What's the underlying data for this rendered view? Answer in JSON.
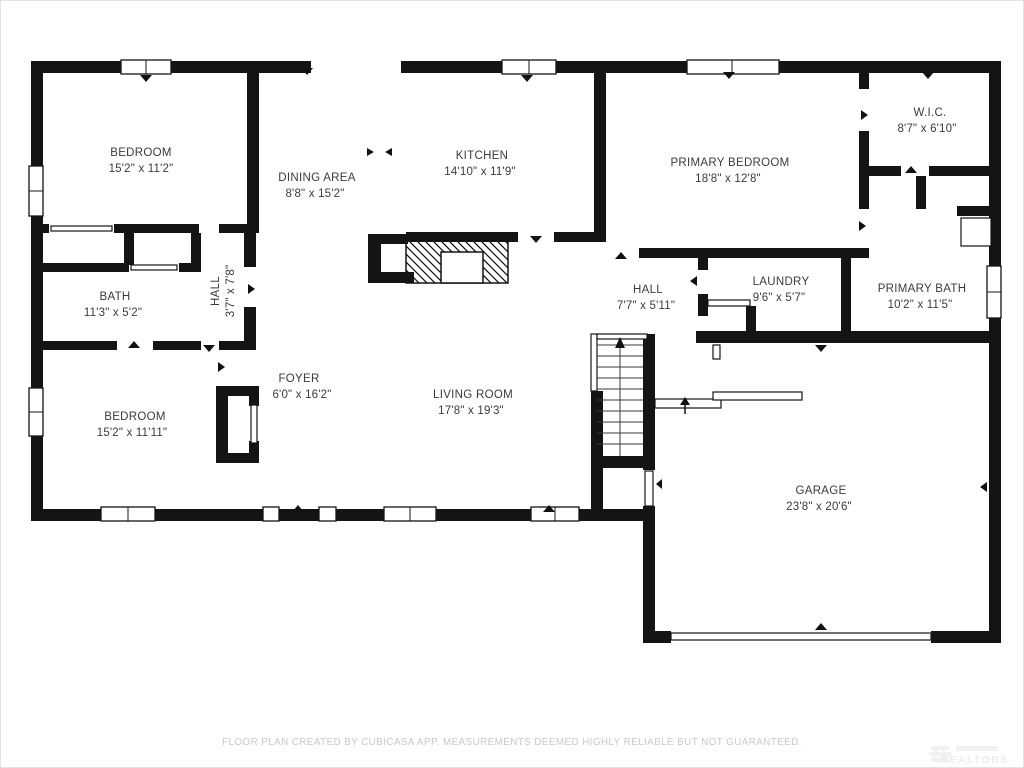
{
  "title": "Floor plan",
  "rooms": [
    {
      "id": "bedroom-top-left",
      "name": "BEDROOM",
      "dims": "15'2\" x 11'2\""
    },
    {
      "id": "dining-area",
      "name": "DINING AREA",
      "dims": "8'8\" x 15'2\""
    },
    {
      "id": "kitchen",
      "name": "KITCHEN",
      "dims": "14'10\" x 11'9\""
    },
    {
      "id": "primary-bedroom",
      "name": "PRIMARY BEDROOM",
      "dims": "18'8\" x 12'8\""
    },
    {
      "id": "walk-in-closet",
      "name": "W.I.C.",
      "dims": "8'7\" x 6'10\""
    },
    {
      "id": "bath",
      "name": "BATH",
      "dims": "11'3\" x 5'2\""
    },
    {
      "id": "hall-small",
      "name": "HALL",
      "dims": "3'7\" x 7'8\""
    },
    {
      "id": "hall",
      "name": "HALL",
      "dims": "7'7\" x 5'11\""
    },
    {
      "id": "laundry",
      "name": "LAUNDRY",
      "dims": "9'6\" x 5'7\""
    },
    {
      "id": "primary-bath",
      "name": "PRIMARY BATH",
      "dims": "10'2\" x 11'5\""
    },
    {
      "id": "foyer",
      "name": "FOYER",
      "dims": "6'0\" x 16'2\""
    },
    {
      "id": "bedroom-bottom-left",
      "name": "BEDROOM",
      "dims": "15'2\" x 11'11\""
    },
    {
      "id": "living-room",
      "name": "LIVING ROOM",
      "dims": "17'8\" x 19'3\""
    },
    {
      "id": "garage",
      "name": "GARAGE",
      "dims": "23'8\" x 20'6\""
    }
  ],
  "footer": {
    "disclaimer": "FLOOR PLAN CREATED BY CUBICASA APP. MEASUREMENTS DEEMED HIGHLY RELIABLE BUT NOT GUARANTEED."
  },
  "watermark": {
    "text": "REALTORS"
  },
  "colors": {
    "wall": "#141414",
    "label": "#3b3b3b",
    "footer_text": "#c8c8c8",
    "watermark": "#ebebeb",
    "background": "#ffffff"
  }
}
